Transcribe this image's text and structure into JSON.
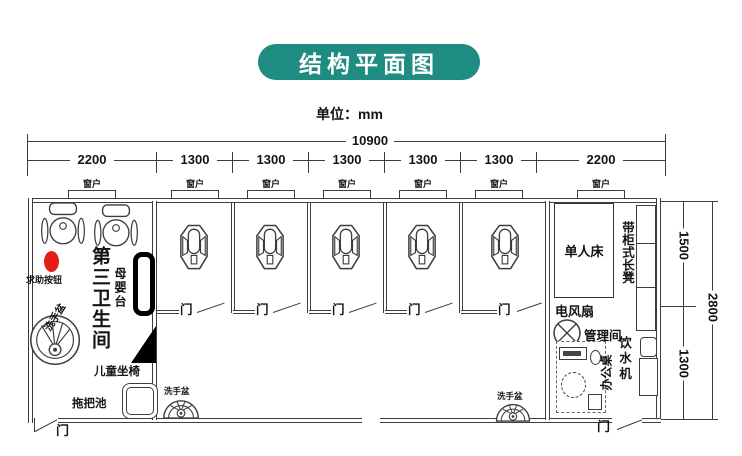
{
  "banner": {
    "title": "结构平面图"
  },
  "unit": {
    "label": "单位：mm"
  },
  "dims": {
    "total": "10900",
    "segments": [
      "2200",
      "1300",
      "1300",
      "1300",
      "1300",
      "1300",
      "2200"
    ],
    "right": {
      "total": "2800",
      "top": "1500",
      "bottom": "1300"
    }
  },
  "labels": {
    "window": "窗户",
    "door": "门",
    "washbasin": "洗手盆",
    "mop_pool": "拖把池",
    "third_restroom": "第三卫生间",
    "help_button": "求助按钮",
    "baby_table": "母婴台",
    "child_seat": "儿童坐椅",
    "single_bed": "单人床",
    "electric_fan": "电风扇",
    "management_room": "管理间",
    "water_dispenser": "饮水机",
    "office_desk": "办公桌",
    "bench": "带柜式长凳"
  },
  "colors": {
    "banner_bg": "#1e8c80",
    "banner_text": "#ffffff",
    "line": "#3d3d3d",
    "help_button": "#e02018"
  }
}
